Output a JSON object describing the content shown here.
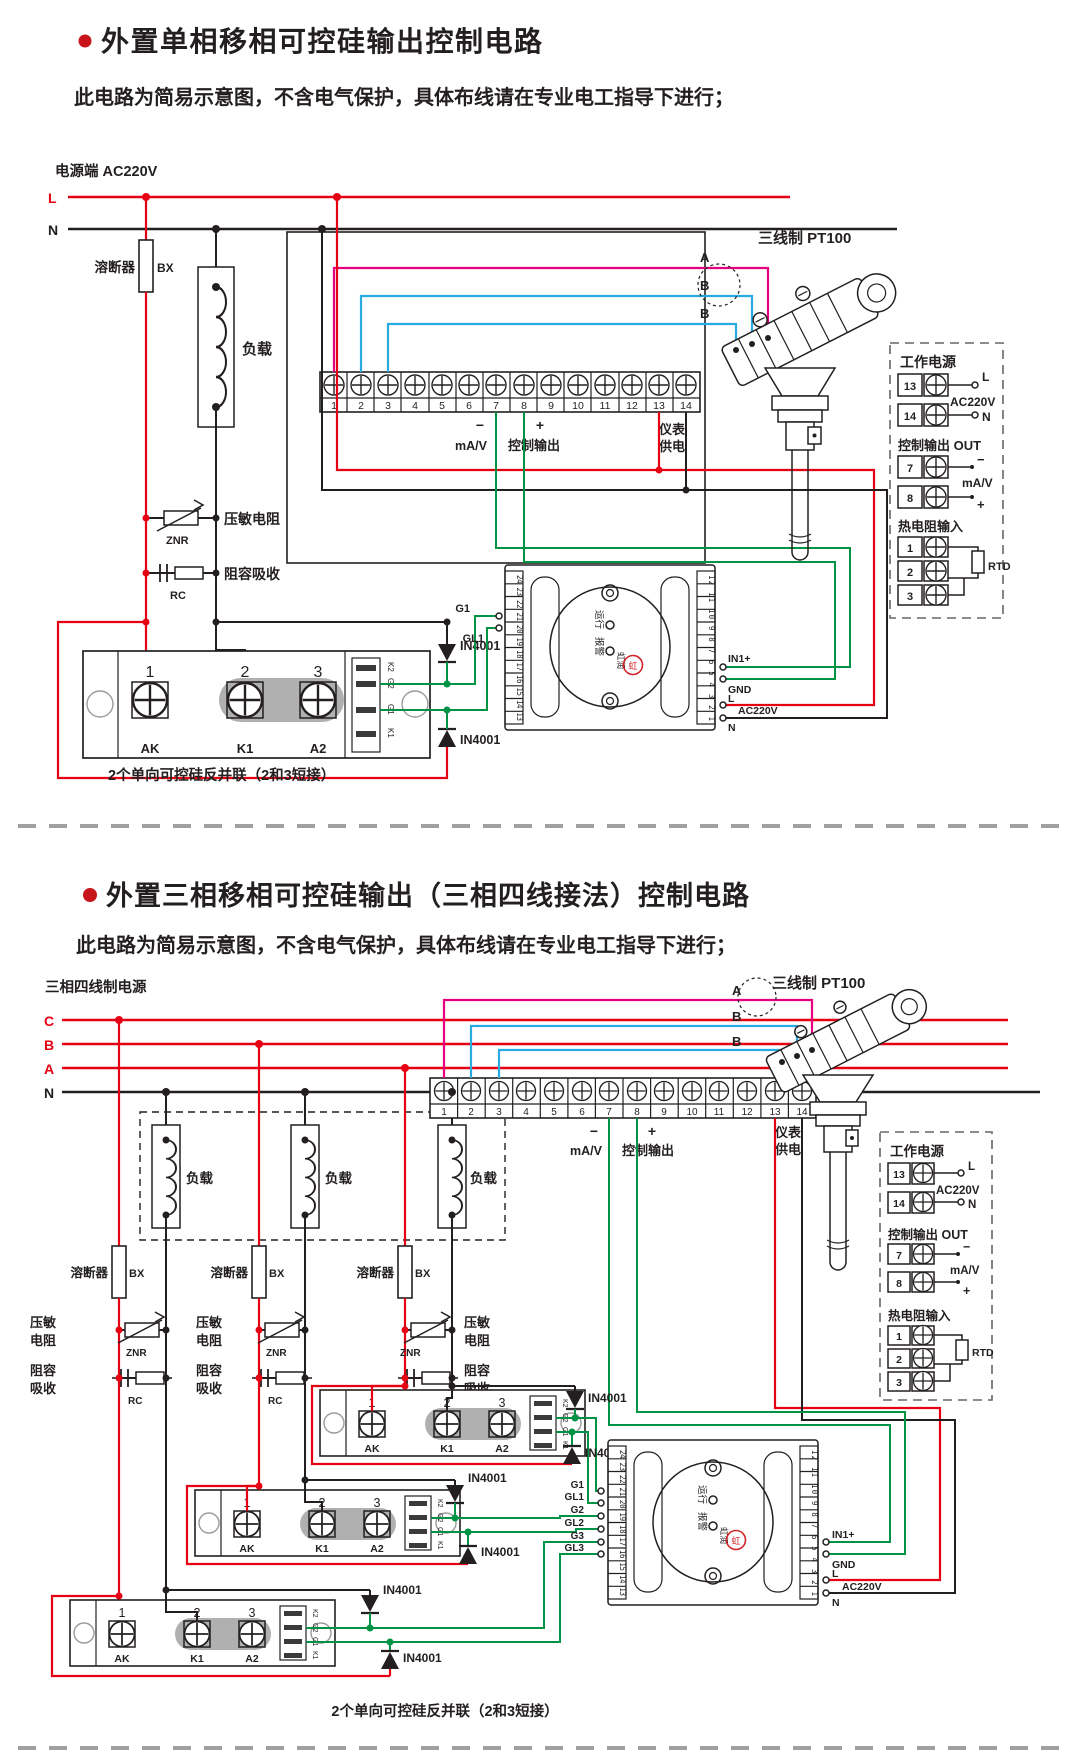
{
  "shared": {
    "diode_label": "IN4001"
  },
  "sec1": {
    "title": "外置单相移相可控硅输出控制电路",
    "subtitle": "此电路为简易示意图，不含电气保护，具体布线请在专业电工指导下进行；",
    "power_label": "电源端  AC220V",
    "rail_l": "L",
    "rail_n": "N",
    "fuse_name": "溶断器",
    "fuse_model": "BX",
    "load_label": "负载",
    "znr_name": "压敏电阻",
    "znr_model": "ZNR",
    "rc_name": "阻容吸收",
    "rc_model": "RC",
    "strip": {
      "nums": [
        "1",
        "2",
        "3",
        "4",
        "5",
        "6",
        "7",
        "8",
        "9",
        "10",
        "11",
        "12",
        "13",
        "14"
      ],
      "minus": "−",
      "plus": "+",
      "mav": "mA/V",
      "ctrl": "控制输出",
      "supply1": "仪表",
      "supply2": "供电"
    },
    "pt100_label": "三线制 PT100",
    "wireA": "A",
    "wireB1": "B",
    "wireB2": "B",
    "scr": {
      "n1": "1",
      "n2": "2",
      "n3": "3",
      "ak": "AK",
      "k1": "K1",
      "a2": "A2",
      "s1": "K2",
      "s2": "G2",
      "s3": "G1",
      "s4": "K1",
      "caption": "2个单向可控硅反并联（2和3短接）"
    },
    "trigger": {
      "left_nums": "24 23 22 21 20 19 18 17 16 15 14 13",
      "right_nums": "12 11 10 9 8 7 6 5 4 3 2 1",
      "g1": "G1",
      "gl1": "GL1",
      "run": "运行",
      "alarm": "报警",
      "brand": "虹润",
      "mark": "虹",
      "in1": "IN1+",
      "gnd": "GND",
      "l": "L",
      "n": "N",
      "ac": "AC220V"
    },
    "legend": {
      "power_title": "工作电源",
      "n13": "13",
      "n14": "14",
      "l": "L",
      "n": "N",
      "ac": "AC220V",
      "out_title": "控制输出 OUT",
      "n7": "7",
      "n8": "8",
      "minus": "−",
      "plus": "+",
      "mav": "mA/V",
      "rtd_title": "热电阻输入",
      "n1": "1",
      "n2": "2",
      "n3": "3",
      "rtd": "RTD"
    }
  },
  "sec2": {
    "title": "外置三相移相可控硅输出（三相四线接法）控制电路",
    "subtitle": "此电路为简易示意图，不含电气保护，具体布线请在专业电工指导下进行；",
    "power_label": "三相四线制电源",
    "rail_c": "C",
    "rail_b": "B",
    "rail_a": "A",
    "rail_n": "N",
    "fuse_name": "溶断器",
    "fuse_model": "BX",
    "load_label": "负载",
    "znr1": "压敏",
    "znr2": "电阻",
    "znr_model": "ZNR",
    "rc1": "阻容",
    "rc2": "吸收",
    "rc_model": "RC",
    "strip": {
      "nums": [
        "1",
        "2",
        "3",
        "4",
        "5",
        "6",
        "7",
        "8",
        "9",
        "10",
        "11",
        "12",
        "13",
        "14"
      ],
      "minus": "−",
      "plus": "+",
      "mav": "mA/V",
      "ctrl": "控制输出",
      "supply1": "仪表",
      "supply2": "供电"
    },
    "pt100_label": "三线制 PT100",
    "wireA": "A",
    "wireB1": "B",
    "wireB2": "B",
    "scr": {
      "n1": "1",
      "n2": "2",
      "n3": "3",
      "ak": "AK",
      "k1": "K1",
      "a2": "A2",
      "s1": "K2",
      "s2": "G2",
      "s3": "G1",
      "s4": "K1",
      "caption": "2个单向可控硅反并联（2和3短接）"
    },
    "trigger": {
      "left_nums": "24 23 22 21 20 19 18 17 16 15 14 13",
      "right_nums": "12 11 10 9 8 7 6 5 4 3 2 1",
      "g1": "G1",
      "gl1": "GL1",
      "g2": "G2",
      "gl2": "GL2",
      "g3": "G3",
      "gl3": "GL3",
      "run": "运行",
      "alarm": "报警",
      "brand": "虹润",
      "mark": "虹",
      "in1": "IN1+",
      "gnd": "GND",
      "l": "L",
      "n": "N",
      "ac": "AC220V"
    },
    "legend": {
      "power_title": "工作电源",
      "n13": "13",
      "n14": "14",
      "l": "L",
      "n": "N",
      "ac": "AC220V",
      "out_title": "控制输出 OUT",
      "n7": "7",
      "n8": "8",
      "minus": "−",
      "plus": "+",
      "mav": "mA/V",
      "rtd_title": "热电阻输入",
      "n1": "1",
      "n2": "2",
      "n3": "3",
      "rtd": "RTD"
    }
  }
}
